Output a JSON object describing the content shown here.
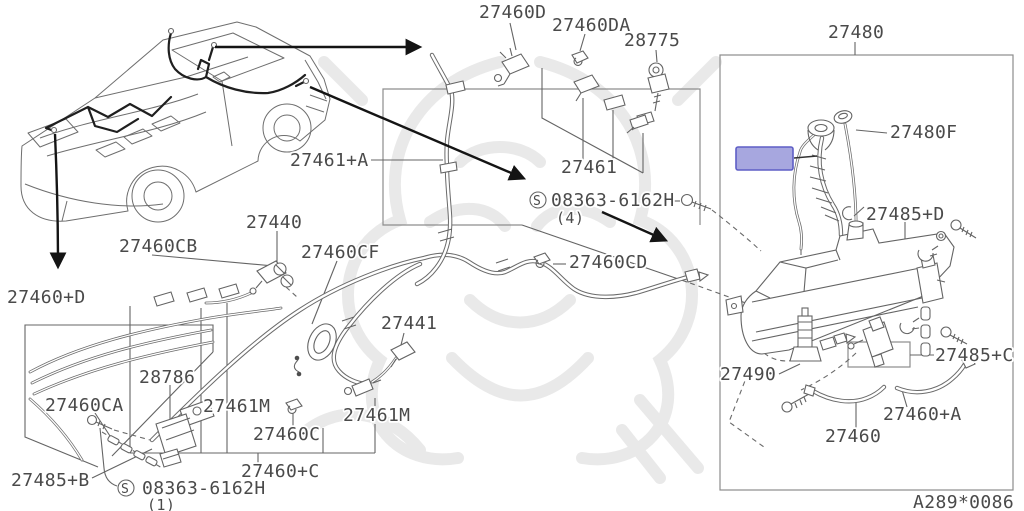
{
  "meta": {
    "sheet_ref": "A289*0086"
  },
  "colors": {
    "highlight_fill": "#a7a7df",
    "highlight_stroke": "#5e5ec6"
  },
  "labels": {
    "p27460d": "27460D",
    "p27460da": "27460DA",
    "p28775": "28775",
    "p27480": "27480",
    "p27461a": "27461+A",
    "p27461": "27461",
    "p27480f": "27480F",
    "p27485d": "27485+D",
    "p27440": "27440",
    "p27460cb": "27460CB",
    "p27460cf": "27460CF",
    "p27460cd": "27460CD",
    "p27460pd": "27460+D",
    "p27441": "27441",
    "p27485c": "27485+C",
    "p27490": "27490",
    "p28786": "28786",
    "p27460ca": "27460CA",
    "p27461m_left": "27461M",
    "p27461m_right": "27461M",
    "p27460c": "27460C",
    "p27460pa": "27460+A",
    "p27460": "27460",
    "p27485b": "27485+B",
    "p27460pc": "27460+C"
  },
  "hardware": {
    "symbol": "S",
    "part_number": "08363-6162H",
    "qty_top": "(4)",
    "qty_bottom": "(1)"
  }
}
